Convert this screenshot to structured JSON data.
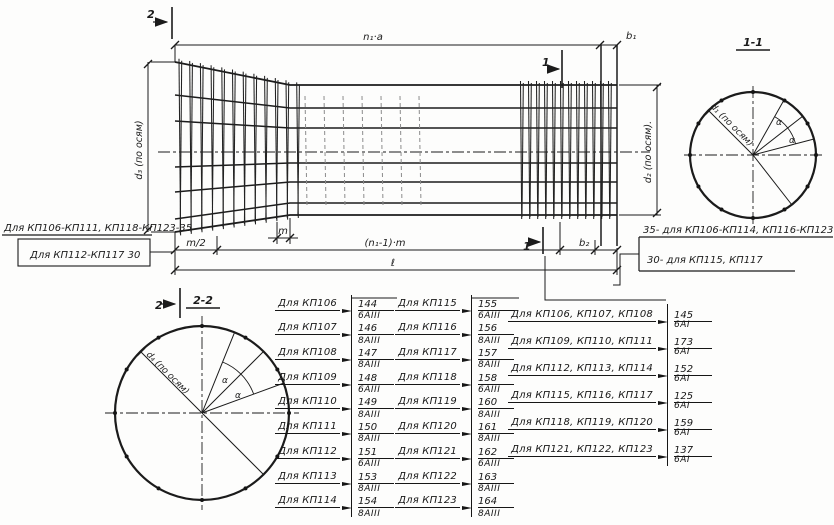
{
  "drawing": {
    "marks": {
      "one": "1",
      "two": "2"
    },
    "sections": {
      "s11": "1-1",
      "s22": "2-2"
    },
    "dims": {
      "top": "n₁·а",
      "b1": "b₁",
      "b2": "b₂",
      "m_half": "m/2",
      "m": "m",
      "span": "(n₁-1)·m",
      "total": "ℓ",
      "d1": "d₁ (по осям)",
      "d2": "d₂ (по осям).",
      "d3": "d₃ (по осям)",
      "d4": "d₄ (по осям)",
      "alpha": "α"
    },
    "notes_left": [
      "Для КП106-КП111, КП118-КП123-35",
      "Для КП112-КП117  30"
    ],
    "notes_right": [
      "35- для КП106-КП114, КП116-КП123",
      "30- для КП115, КП117"
    ]
  },
  "tables": [
    {
      "rows": [
        {
          "label": "Для КП106",
          "num": "144",
          "den": "6АIII"
        },
        {
          "label": "Для КП107",
          "num": "146",
          "den": "8АIII"
        },
        {
          "label": "Для КП108",
          "num": "147",
          "den": "8АIII"
        },
        {
          "label": "Для КП109",
          "num": "148",
          "den": "6АIII"
        },
        {
          "label": "Для КП110",
          "num": "149",
          "den": "8АIII"
        },
        {
          "label": "Для КП111",
          "num": "150",
          "den": "8АIII"
        },
        {
          "label": "Для КП112",
          "num": "151",
          "den": "6АIII"
        },
        {
          "label": "Для КП113",
          "num": "153",
          "den": "8АIII"
        },
        {
          "label": "Для КП114",
          "num": "154",
          "den": "8АIII"
        }
      ]
    },
    {
      "rows": [
        {
          "label": "Для КП115",
          "num": "155",
          "den": "6АIII"
        },
        {
          "label": "Для КП116",
          "num": "156",
          "den": "8АIII"
        },
        {
          "label": "Для КП117",
          "num": "157",
          "den": "8АIII"
        },
        {
          "label": "Для КП118",
          "num": "158",
          "den": "6АIII"
        },
        {
          "label": "Для КП119",
          "num": "160",
          "den": "8АIII"
        },
        {
          "label": "Для КП120",
          "num": "161",
          "den": "8АIII"
        },
        {
          "label": "Для КП121",
          "num": "162",
          "den": "6АIII"
        },
        {
          "label": "Для КП122",
          "num": "163",
          "den": "8АIII"
        },
        {
          "label": "Для КП123",
          "num": "164",
          "den": "8АIII"
        }
      ]
    },
    {
      "rows": [
        {
          "label": "Для КП106, КП107, КП108",
          "num": "145",
          "den": "6АI"
        },
        {
          "label": "Для КП109, КП110, КП111",
          "num": "173",
          "den": "6АI"
        },
        {
          "label": "Для КП112, КП113, КП114",
          "num": "152",
          "den": "6АI"
        },
        {
          "label": "Для КП115, КП116, КП117",
          "num": "125",
          "den": "6АI"
        },
        {
          "label": "Для КП118, КП119, КП120",
          "num": "159",
          "den": "6АI"
        },
        {
          "label": "Для КП121, КП122, КП123",
          "num": "137",
          "den": "6АI"
        }
      ]
    }
  ]
}
